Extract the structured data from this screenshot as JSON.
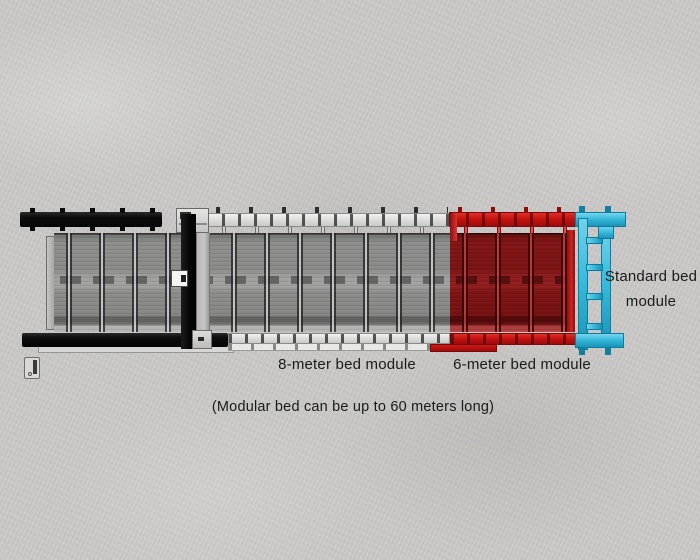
{
  "modules": [
    {
      "label": "8-meter bed module",
      "color": "#8e8e8c"
    },
    {
      "label": "6-meter bed module",
      "color": "#c51210"
    },
    {
      "label": "Standard bed module",
      "color": "#35b9da"
    }
  ],
  "caption": "(Modular bed can be up to 60 meters long)",
  "colors": {
    "background": "#cac9c7",
    "rail_black": "#0c0c0c",
    "rail_white": "#dededc",
    "rail_red": "#c51210",
    "panel_gray": "#8e8e8c",
    "panel_red": "#7c1313",
    "module_cyan": "#35b9da",
    "text": "#1b1b1b"
  }
}
